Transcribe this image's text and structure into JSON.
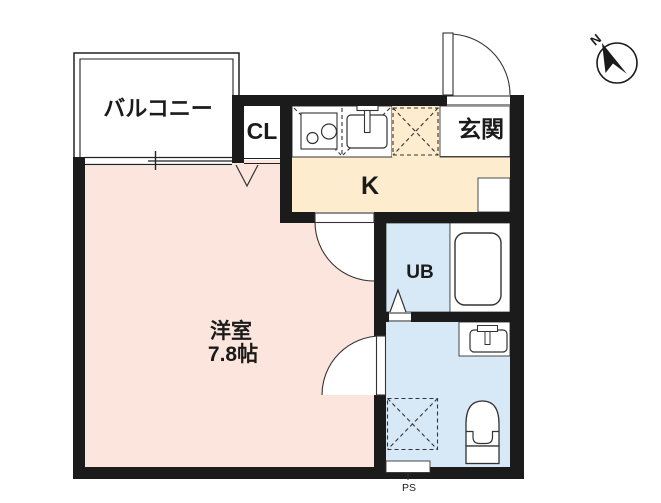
{
  "rooms": {
    "balcony": {
      "label": "バルコニー"
    },
    "closet": {
      "label": "CL"
    },
    "entrance": {
      "label": "玄関"
    },
    "kitchen": {
      "label": "K"
    },
    "main_room": {
      "label": "洋室",
      "size": "7.8帖"
    },
    "unit_bath": {
      "label": "UB"
    },
    "pipe_space": {
      "label": "PS"
    }
  },
  "compass": {
    "label": "N"
  },
  "colors": {
    "room_pink": "#fbe5dc",
    "kitchen_cream": "#fdecce",
    "wet_blue": "#d7e9f6",
    "wall": "#1b1b1b",
    "line": "#222222"
  }
}
